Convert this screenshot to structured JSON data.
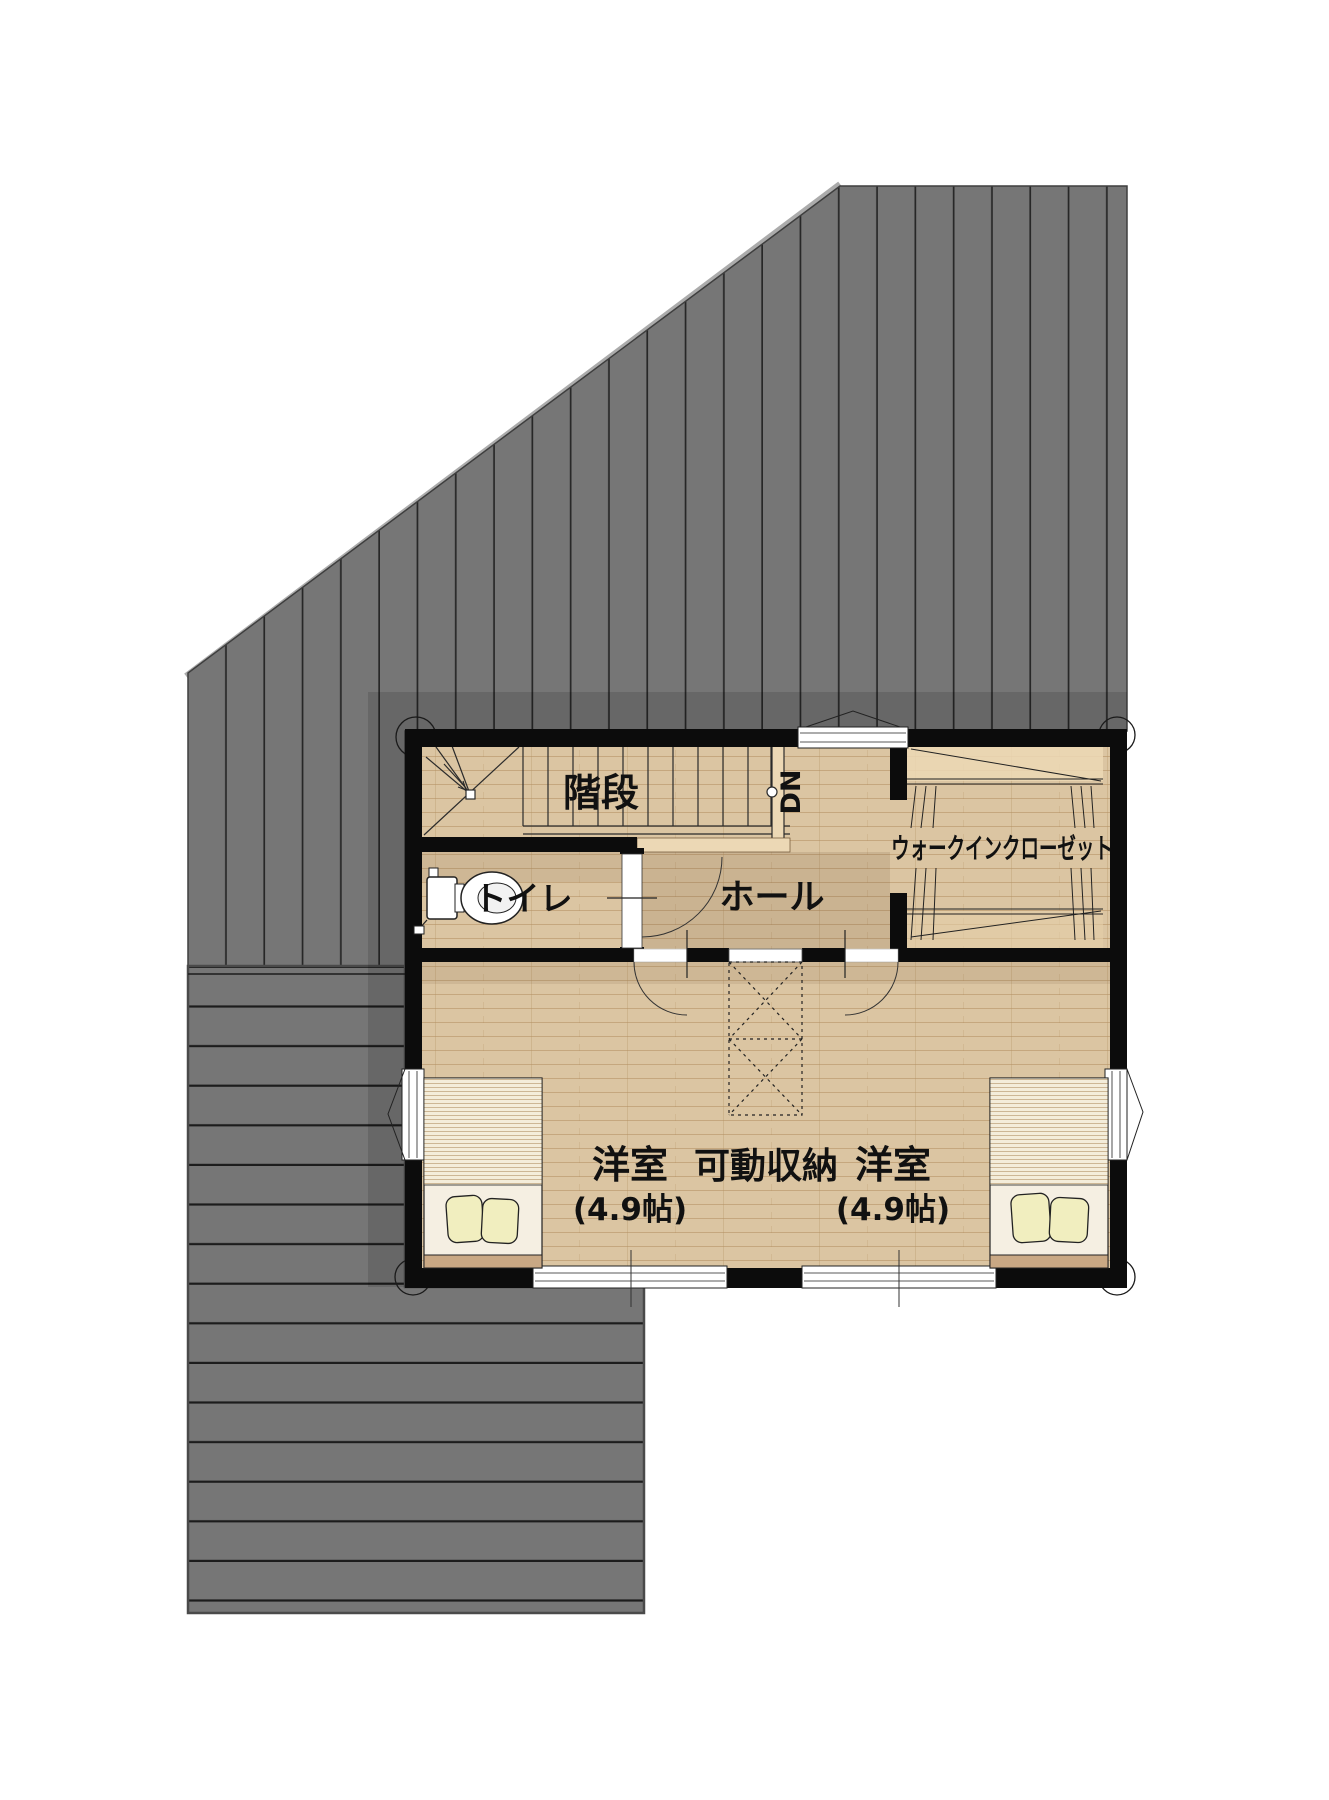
{
  "plan": {
    "title": "2F floor plan",
    "rooms": {
      "stairs": {
        "label": "階段"
      },
      "down_marker": {
        "label": "DN"
      },
      "walk_in_closet": {
        "label": "ウォークインクローゼット"
      },
      "toilet": {
        "label": "トイレ"
      },
      "hall": {
        "label": "ホール"
      },
      "bedroom_left": {
        "label": "洋室",
        "size": "(4.9帖)"
      },
      "bedroom_right": {
        "label": "洋室",
        "size": "(4.9帖)"
      },
      "movable_storage": {
        "label": "可動収納"
      }
    },
    "colors": {
      "roof": "#767676",
      "roof_stripe": "#272727",
      "deck": "#767676",
      "deck_stripe": "#1c1c1c",
      "wall": "#0c0c0c",
      "floor": "#dbc5a2",
      "floor_line": "#a5794d",
      "fixture_white": "#ffffff",
      "pillow": "#f1eebf"
    }
  }
}
